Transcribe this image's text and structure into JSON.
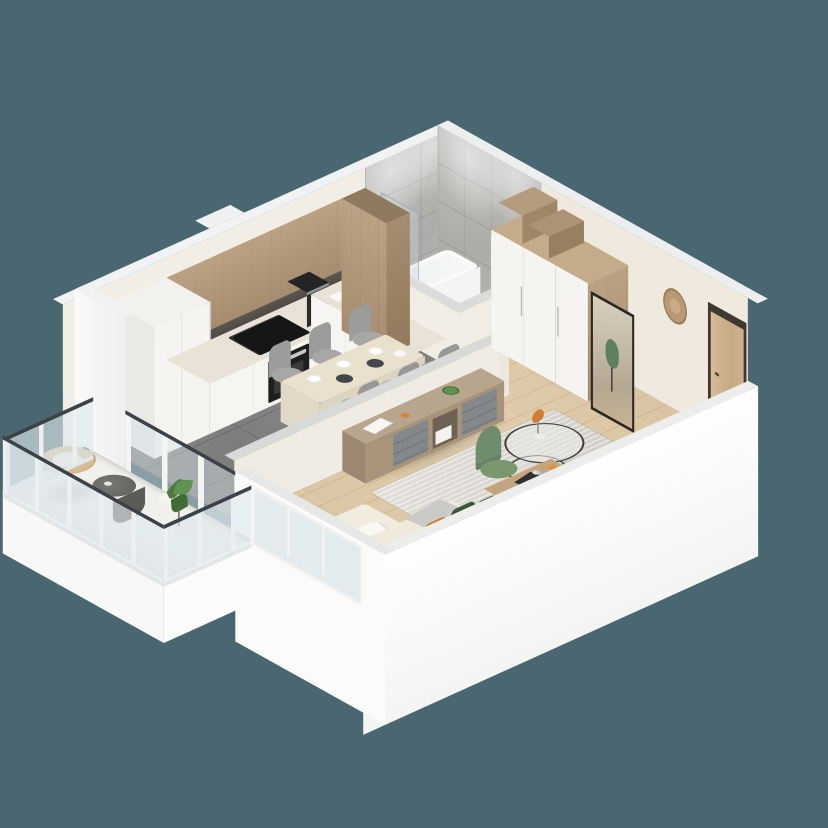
{
  "scene": {
    "type": "isometric-3d-floor-plan-render",
    "title": "studio apartment 3d floor plan",
    "background_color": "#4A6670",
    "rooms": [
      {
        "name": "kitchen-dining",
        "floor": "dark gray ceramic tile",
        "items": [
          "tall-white-cabinets",
          "wood-upper-cabinets",
          "white-base-cabinets",
          "induction-cooktop",
          "built-in-oven",
          "coffee-machine",
          "sink-unit",
          "tall-wood-cabinet",
          "dining-table",
          "gray-dining-chairs",
          "white-plates",
          "dark-placemats"
        ]
      },
      {
        "name": "living-room",
        "floor": "light oak planks",
        "items": [
          "media-sideboard",
          "potted-plant",
          "white-books",
          "orange-bowl",
          "area-rug",
          "round-wire-coffee-table",
          "orange-flower-vase",
          "corner-sofa",
          "green-pillows",
          "orange-pillows",
          "gray-throw",
          "white-throw",
          "desk",
          "desk-lamp",
          "laptop",
          "green-shell-chair",
          "orange-twigs"
        ]
      },
      {
        "name": "bathroom",
        "floor": "light gray tile",
        "items": [
          "bathtub",
          "glass-shower-screen",
          "chrome-shower-fixture",
          "toilet",
          "tall-white-cabinet",
          "marble-tile-walls",
          "ceiling-spotlights"
        ]
      },
      {
        "name": "hallway",
        "floor": "light oak planks",
        "items": [
          "white-wardrobe",
          "wood-storage-boxes",
          "floor-mirror",
          "mirror-reflection-green-chair",
          "round-wood-wall-clock",
          "intercom-panel",
          "wood-entrance-door"
        ]
      },
      {
        "name": "balcony",
        "floor": "white decking",
        "items": [
          "glass-railing",
          "rattan-lounge-chair",
          "round-gray-side-table",
          "white-stool",
          "potted-palm"
        ]
      }
    ],
    "palette": {
      "background": "#4A6670",
      "wall_top": "#F1F2F3",
      "outer_wall": "#FBFBFA",
      "inner_wall": "#F3EEE5",
      "kitchen_tile_floor": "#807F7C",
      "wood_floor": "#D9C4A4",
      "bath_floor_tile": "#C8C7C3",
      "bath_wall_marble": "#B8B6B3",
      "cabinet_wood": "#B1987B",
      "cabinet_white": "#F6F5F2",
      "counter_top": "#E9E3D7",
      "appliance_black": "#1E1E1E",
      "sofa_cream": "#F0EADC",
      "pillow_green": "#3E5639",
      "pillow_orange": "#C57C2B",
      "rug_gray": "#DBD8D1",
      "chair_green": "#6F8D6C",
      "desk_wood": "#C3A57F",
      "entrance_door_wood": "#CDB28E",
      "railing_glass": "rgba(214,226,232,0.5)",
      "railing_top_bar": "#3A4148"
    }
  }
}
